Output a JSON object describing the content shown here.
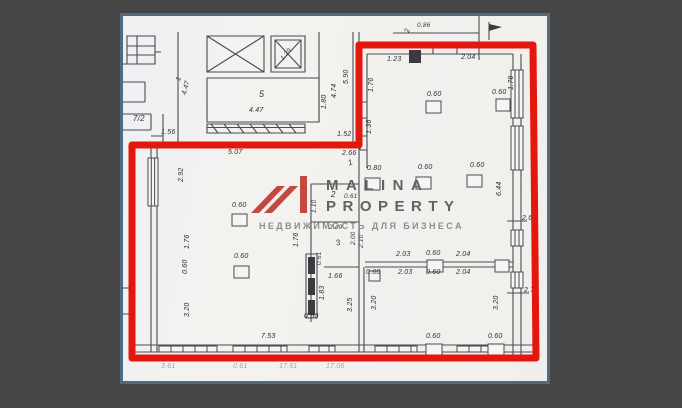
{
  "scene": {
    "background_color": "#464646",
    "frame_border_color": "#516a80",
    "paper_color": "#f1f0ee",
    "outline_color": "#e3170d",
    "line_color": "#4a4a52"
  },
  "watermark": {
    "line1": "MALINA",
    "line2": "PROPERTY",
    "tagline": "НЕДВИЖИМОСТЬ ДЛЯ БИЗНЕСА",
    "logo": "malina-m-logo",
    "logo_color": "#bf3a33",
    "text_color": "#616161",
    "tagline_color": "#8d8d8d"
  },
  "plan": {
    "room_numbers": [
      "1",
      "2",
      "3",
      "5",
      "7/2"
    ],
    "labels": [
      {
        "t": "1",
        "x": 52,
        "y": 64,
        "r": -75,
        "c": "dim"
      },
      {
        "t": "4.47",
        "x": 58,
        "y": 78,
        "r": -75,
        "c": "dim"
      },
      {
        "t": "7/2",
        "x": 10,
        "y": 99,
        "r": 0,
        "c": "room-sm"
      },
      {
        "t": "1.56",
        "x": 38,
        "y": 113,
        "r": 0,
        "c": "dim"
      },
      {
        "t": "1.29",
        "x": 157,
        "y": 42,
        "r": -50,
        "c": "tiny"
      },
      {
        "t": "5",
        "x": 136,
        "y": 74,
        "r": 0,
        "c": "room"
      },
      {
        "t": "4.47",
        "x": 126,
        "y": 91,
        "r": 0,
        "c": "dim"
      },
      {
        "t": "1.80",
        "x": 198,
        "y": 93,
        "r": -90,
        "c": "dim"
      },
      {
        "t": "4.74",
        "x": 208,
        "y": 82,
        "r": -90,
        "c": "dim"
      },
      {
        "t": "5.90",
        "x": 220,
        "y": 68,
        "r": -90,
        "c": "dim"
      },
      {
        "t": "2",
        "x": 281,
        "y": 16,
        "r": -80,
        "c": "dim"
      },
      {
        "t": "0.86",
        "x": 294,
        "y": 7,
        "r": 0,
        "c": "tiny"
      },
      {
        "t": "1.52",
        "x": 214,
        "y": 115,
        "r": 0,
        "c": "dim"
      },
      {
        "t": "2.66",
        "x": 219,
        "y": 134,
        "r": 0,
        "c": "dim"
      },
      {
        "t": "1",
        "x": 224,
        "y": 144,
        "r": -20,
        "c": "room-sm"
      },
      {
        "t": "1.23",
        "x": 264,
        "y": 40,
        "r": 0,
        "c": "dim"
      },
      {
        "t": "2.04",
        "x": 338,
        "y": 38,
        "r": 0,
        "c": "dim"
      },
      {
        "t": "1.76",
        "x": 245,
        "y": 76,
        "r": -90,
        "c": "dim"
      },
      {
        "t": "1.76",
        "x": 385,
        "y": 74,
        "r": -90,
        "c": "dim"
      },
      {
        "t": "0.60",
        "x": 304,
        "y": 75,
        "r": 0,
        "c": "dim"
      },
      {
        "t": "0.60",
        "x": 369,
        "y": 73,
        "r": 0,
        "c": "dim"
      },
      {
        "t": "1.36",
        "x": 243,
        "y": 118,
        "r": -90,
        "c": "dim"
      },
      {
        "t": "6.44",
        "x": 373,
        "y": 180,
        "r": -90,
        "c": "dim"
      },
      {
        "t": "2.6",
        "x": 399,
        "y": 199,
        "r": 0,
        "c": "dim"
      },
      {
        "t": "2.7",
        "x": 401,
        "y": 271,
        "r": 0,
        "c": "dim"
      },
      {
        "t": "0.80",
        "x": 244,
        "y": 149,
        "r": 0,
        "c": "dim"
      },
      {
        "t": "0.60",
        "x": 295,
        "y": 148,
        "r": 0,
        "c": "dim"
      },
      {
        "t": "0.60",
        "x": 347,
        "y": 146,
        "r": 0,
        "c": "dim"
      },
      {
        "t": "5.07",
        "x": 105,
        "y": 133,
        "r": 0,
        "c": "dim"
      },
      {
        "t": "2.92",
        "x": 55,
        "y": 166,
        "r": -90,
        "c": "dim"
      },
      {
        "t": "0.60",
        "x": 109,
        "y": 186,
        "r": 0,
        "c": "dim"
      },
      {
        "t": "1.76",
        "x": 61,
        "y": 233,
        "r": -90,
        "c": "dim"
      },
      {
        "t": "0.60",
        "x": 59,
        "y": 258,
        "r": -90,
        "c": "dim"
      },
      {
        "t": "0.60",
        "x": 111,
        "y": 237,
        "r": 0,
        "c": "dim"
      },
      {
        "t": "3.20",
        "x": 61,
        "y": 301,
        "r": -90,
        "c": "dim"
      },
      {
        "t": "7.53",
        "x": 138,
        "y": 317,
        "r": 0,
        "c": "dim"
      },
      {
        "t": "2",
        "x": 208,
        "y": 175,
        "r": 0,
        "c": "room-sm"
      },
      {
        "t": "0.61",
        "x": 221,
        "y": 178,
        "r": 0,
        "c": "tiny"
      },
      {
        "t": "1.10",
        "x": 189,
        "y": 197,
        "r": -90,
        "c": "tiny"
      },
      {
        "t": "2.49",
        "x": 206,
        "y": 209,
        "r": 0,
        "c": "tiny"
      },
      {
        "t": "3",
        "x": 212,
        "y": 224,
        "r": -15,
        "c": "room-sm"
      },
      {
        "t": "1.76",
        "x": 170,
        "y": 231,
        "r": -90,
        "c": "dim"
      },
      {
        "t": "2.00",
        "x": 228,
        "y": 229,
        "r": -90,
        "c": "tiny"
      },
      {
        "t": "2.10",
        "x": 236,
        "y": 232,
        "r": -90,
        "c": "tiny"
      },
      {
        "t": "0.61",
        "x": 194,
        "y": 249,
        "r": -90,
        "c": "tiny"
      },
      {
        "t": "1.66",
        "x": 205,
        "y": 257,
        "r": 0,
        "c": "dim"
      },
      {
        "t": "1.83",
        "x": 196,
        "y": 284,
        "r": -90,
        "c": "dim"
      },
      {
        "t": "3.25",
        "x": 224,
        "y": 296,
        "r": -90,
        "c": "dim"
      },
      {
        "t": "0.50",
        "x": 181,
        "y": 297,
        "r": 0,
        "c": "dim"
      },
      {
        "t": "2.03",
        "x": 273,
        "y": 235,
        "r": 0,
        "c": "dim"
      },
      {
        "t": "0.60",
        "x": 303,
        "y": 234,
        "r": 0,
        "c": "dim"
      },
      {
        "t": "2.04",
        "x": 333,
        "y": 235,
        "r": 0,
        "c": "dim"
      },
      {
        "t": "0.60",
        "x": 243,
        "y": 253,
        "r": 0,
        "c": "dim"
      },
      {
        "t": "2.03",
        "x": 275,
        "y": 253,
        "r": 0,
        "c": "dim"
      },
      {
        "t": "0.60",
        "x": 303,
        "y": 253,
        "r": 0,
        "c": "dim"
      },
      {
        "t": "2.04",
        "x": 333,
        "y": 253,
        "r": 0,
        "c": "dim"
      },
      {
        "t": "3.20",
        "x": 248,
        "y": 294,
        "r": -90,
        "c": "dim"
      },
      {
        "t": "3.20",
        "x": 370,
        "y": 294,
        "r": -90,
        "c": "dim"
      },
      {
        "t": "0.60",
        "x": 303,
        "y": 317,
        "r": 0,
        "c": "dim"
      },
      {
        "t": "0.60",
        "x": 365,
        "y": 317,
        "r": 0,
        "c": "dim"
      },
      {
        "t": "3.61",
        "x": 38,
        "y": 347,
        "r": 0,
        "c": "faint"
      },
      {
        "t": "0.61",
        "x": 110,
        "y": 347,
        "r": 0,
        "c": "faint"
      },
      {
        "t": "17.61",
        "x": 156,
        "y": 347,
        "r": 0,
        "c": "faint"
      },
      {
        "t": "17.06",
        "x": 203,
        "y": 347,
        "r": 0,
        "c": "faint"
      }
    ]
  }
}
